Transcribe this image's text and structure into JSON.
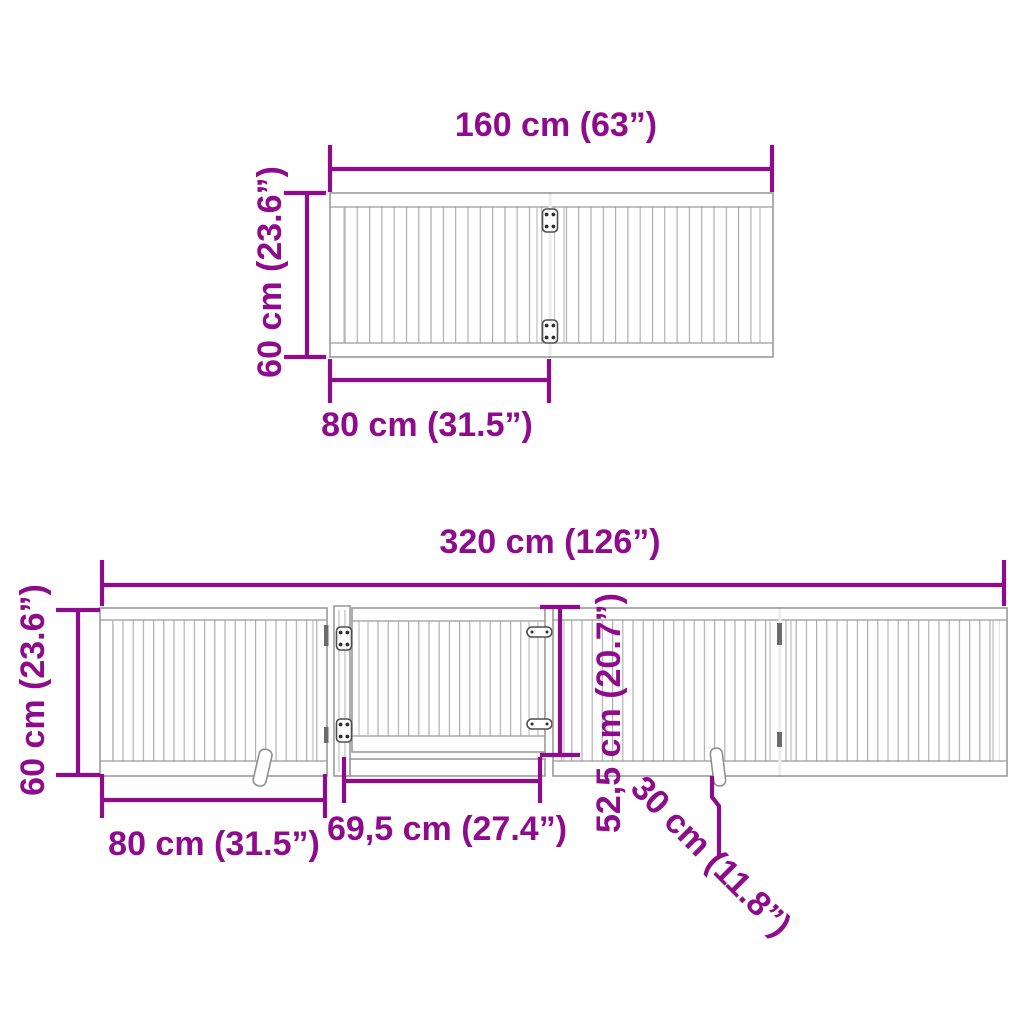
{
  "colors": {
    "accent": "#8E0B8C",
    "line": "#9A9A9A"
  },
  "top_diagram": {
    "width_label": "160 cm (63”)",
    "height_label": "60 cm (23.6”)",
    "panel_width_label": "80 cm (31.5”)"
  },
  "bottom_diagram": {
    "total_width_label": "320 cm (126”)",
    "height_label": "60 cm (23.6”)",
    "panel_width_label": "80 cm (31.5”)",
    "door_width_label": "69,5 cm (27.4”)",
    "door_height_label": "52,5 cm (20.7”)",
    "foot_depth_label": "30 cm (11.8”)"
  }
}
